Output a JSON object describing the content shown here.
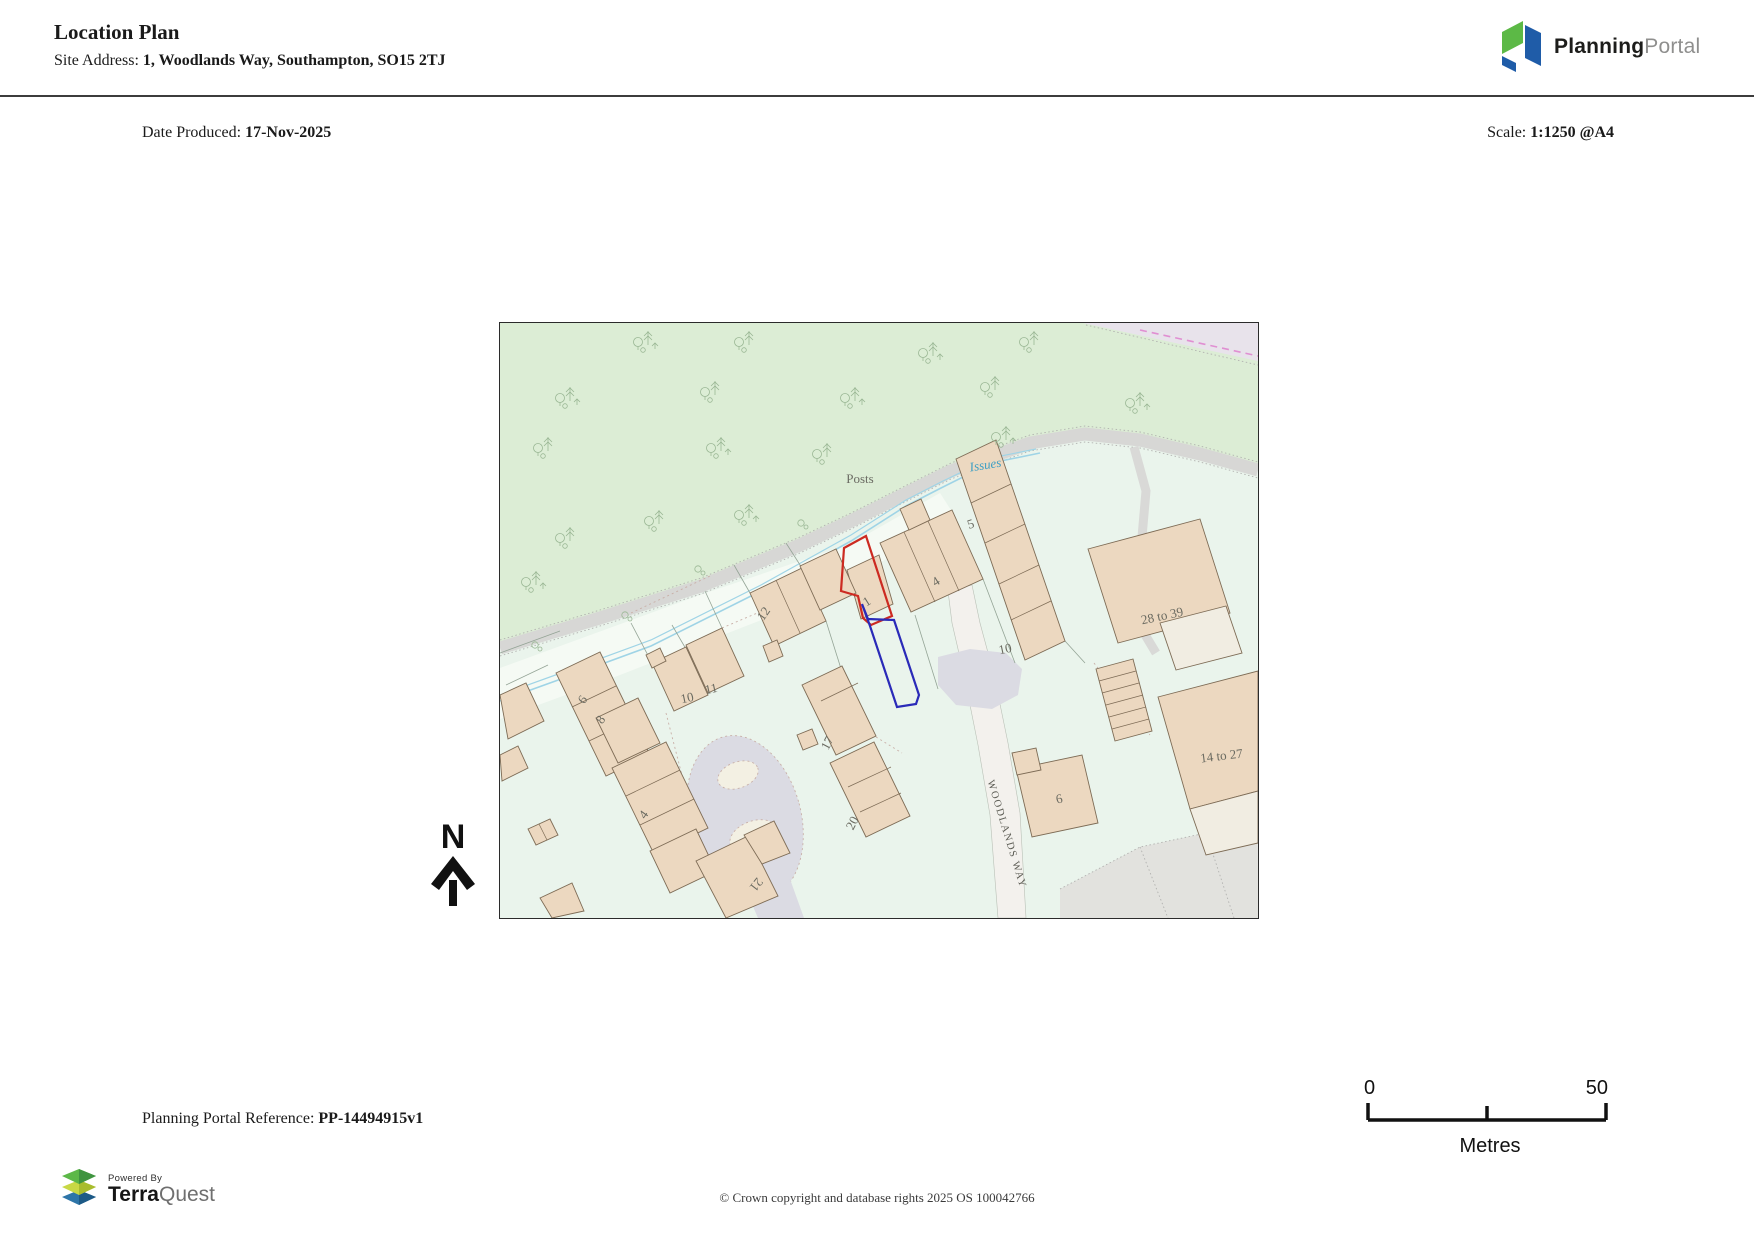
{
  "header": {
    "title": "Location Plan",
    "site_address_label": "Site Address: ",
    "site_address": "1, Woodlands Way, Southampton, SO15 2TJ",
    "logo": {
      "brand_bold": "Planning",
      "brand_light": "Portal"
    }
  },
  "meta": {
    "date_label": "Date Produced: ",
    "date": "17-Nov-2025",
    "scale_label": "Scale: ",
    "scale": "1:1250 @A4"
  },
  "map": {
    "north_label": "N",
    "colors": {
      "site_boundary_red": "#cc2a21",
      "secondary_boundary_blue": "#2a2ab8",
      "woodland_green": "#dcedd5",
      "building_beige": "#ecd8c0",
      "road_grey": "#dbdbe3",
      "water_blue": "#9fd4e6"
    },
    "labels": [
      {
        "text": "Posts",
        "x": 360,
        "y": 160,
        "r": 0,
        "cls": "posts"
      },
      {
        "text": "Issues",
        "x": 486,
        "y": 146,
        "r": -9,
        "cls": "issues"
      },
      {
        "text": "5",
        "x": 472,
        "y": 205,
        "r": -18,
        "cls": "num"
      },
      {
        "text": "4",
        "x": 438,
        "y": 262,
        "r": -32,
        "cls": "num"
      },
      {
        "text": "1",
        "x": 369,
        "y": 282,
        "r": -32,
        "cls": "num"
      },
      {
        "text": "10",
        "x": 506,
        "y": 330,
        "r": -12,
        "cls": "num"
      },
      {
        "text": "12",
        "x": 267,
        "y": 293,
        "r": -55,
        "cls": "num"
      },
      {
        "text": "10",
        "x": 188,
        "y": 379,
        "r": -12,
        "cls": "num"
      },
      {
        "text": "11",
        "x": 212,
        "y": 370,
        "r": -12,
        "cls": "num"
      },
      {
        "text": "6",
        "x": 86,
        "y": 379,
        "r": -55,
        "cls": "num"
      },
      {
        "text": "8",
        "x": 104,
        "y": 399,
        "r": -55,
        "cls": "num"
      },
      {
        "text": "4",
        "x": 147,
        "y": 494,
        "r": -55,
        "cls": "num"
      },
      {
        "text": "17",
        "x": 331,
        "y": 422,
        "r": -62,
        "cls": "num"
      },
      {
        "text": "20",
        "x": 356,
        "y": 502,
        "r": -62,
        "cls": "num"
      },
      {
        "text": "21",
        "x": 253,
        "y": 559,
        "r": 128,
        "cls": "num"
      },
      {
        "text": "6",
        "x": 560,
        "y": 480,
        "r": -12,
        "cls": "num"
      },
      {
        "text": "28 to 39",
        "x": 663,
        "y": 297,
        "r": -12,
        "cls": "num"
      },
      {
        "text": "14 to 27",
        "x": 722,
        "y": 437,
        "r": -7,
        "cls": "num"
      },
      {
        "text": "WOODLANDS WAY",
        "x": 504,
        "y": 512,
        "r": 73,
        "cls": "road"
      }
    ]
  },
  "scalebar": {
    "start": "0",
    "end": "50",
    "unit": "Metres"
  },
  "footer": {
    "reference_label": "Planning Portal Reference: ",
    "reference": "PP-14494915v1",
    "copyright": "© Crown copyright and database rights 2025 OS 100042766",
    "terraquest": {
      "powered_by": "Powered By",
      "brand_bold": "Terra",
      "brand_light": "Quest"
    }
  }
}
